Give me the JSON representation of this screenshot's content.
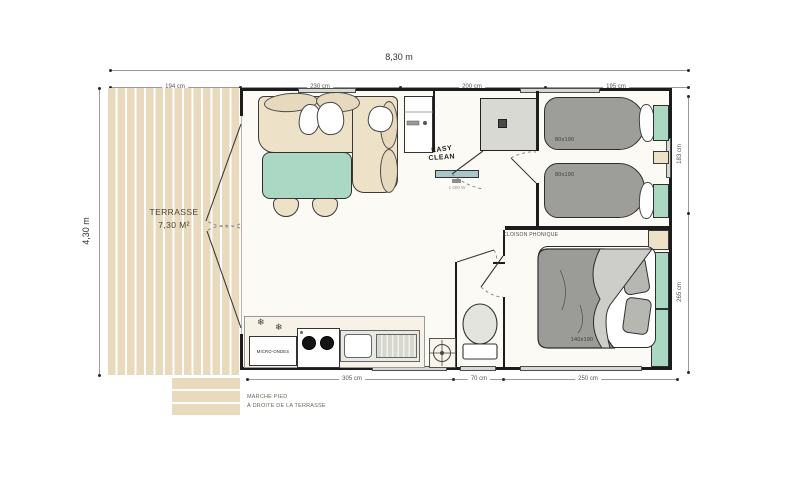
{
  "dimensions": {
    "total_width": "8,30 m",
    "total_height": "4,30 m",
    "top_segments": [
      "194 cm",
      "230 cm",
      "200 cm",
      "195 cm"
    ],
    "right_segments": [
      "183 cm",
      "265 cm"
    ],
    "bottom_segments": [
      "305 cm",
      "70 cm",
      "250 cm"
    ]
  },
  "terrace": {
    "title": "TERRASSE",
    "area": "7,30 M²"
  },
  "steps_note": {
    "line1": "MARCHE PIED",
    "line2": "À DROITE DE LA TERRASSE"
  },
  "bathroom": {
    "easy_line1": "EASY",
    "easy_line2": "CLEAN"
  },
  "hallway": {
    "radiator_power": "1 000 W"
  },
  "kitchen": {
    "microwave": "MICRO-ONDES",
    "snowflake_icon": "❄"
  },
  "bedrooms": {
    "partition_label": "CLOISON PHONIQUE",
    "twin_bed_1_size": "80x190",
    "twin_bed_2_size": "80x190",
    "double_bed_size": "140x190"
  },
  "colors": {
    "wall": "#1c1c1c",
    "wood": "#e9dabe",
    "teal": "#abd7c5",
    "duvet_grey": "#9d9d9a",
    "beige": "#ede1c8",
    "floor": "#fcfaf4",
    "shower_grey": "#d9d9d4",
    "dim_line": "#9a9a9a"
  }
}
